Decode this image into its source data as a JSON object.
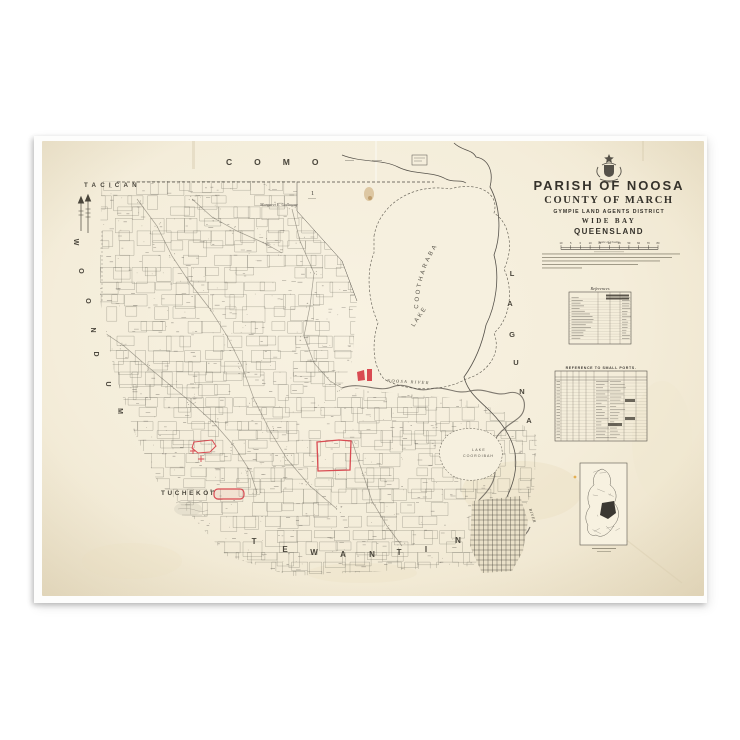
{
  "poster": {
    "title_block": {
      "crest": "queensland-crest",
      "parish_line": "PARISH OF NOOSA",
      "county_line": "COUNTY OF MARCH",
      "district_line": "GYMPIE LAND AGENTS DISTRICT",
      "region_line": "WIDE BAY",
      "state_line": "QUEENSLAND",
      "scale_label": "Scale of Chains",
      "scale_ticks": [
        "10",
        "5",
        "0",
        "10",
        "20",
        "30",
        "40",
        "50",
        "60",
        "70",
        "80"
      ]
    },
    "labels": {
      "como": "COMO",
      "tacican": "TACICAN",
      "woondum": "WOONDUM",
      "laguna": "LAGUNA",
      "lake_cootharaba_word1": "LAKE",
      "lake_cootharaba_word2": "COOTHARABA",
      "lake_cooroibah_word1": "LAKE",
      "lake_cooroibah_word2": "COOROIBAH",
      "noosa_river": "NOOSA RIVER",
      "river_word": "RIVER",
      "tuchekoi": "TUCHEKOI",
      "tuchekoi_suffix": "Pa.",
      "tewantin": "TEWANTIN",
      "settler_name": "Margaret E. Galloway",
      "portion_one": "1"
    },
    "tables": {
      "references_title": "References",
      "small_ports_title": "REFERENCE TO SMALL PORTS."
    },
    "colors": {
      "paper": "#f5efdd",
      "ink": "#4a463c",
      "title_ink": "#35322b",
      "red": "#d94b52",
      "stain_brown": "#b98c4a",
      "stain_yellow": "#e2a43c"
    }
  }
}
